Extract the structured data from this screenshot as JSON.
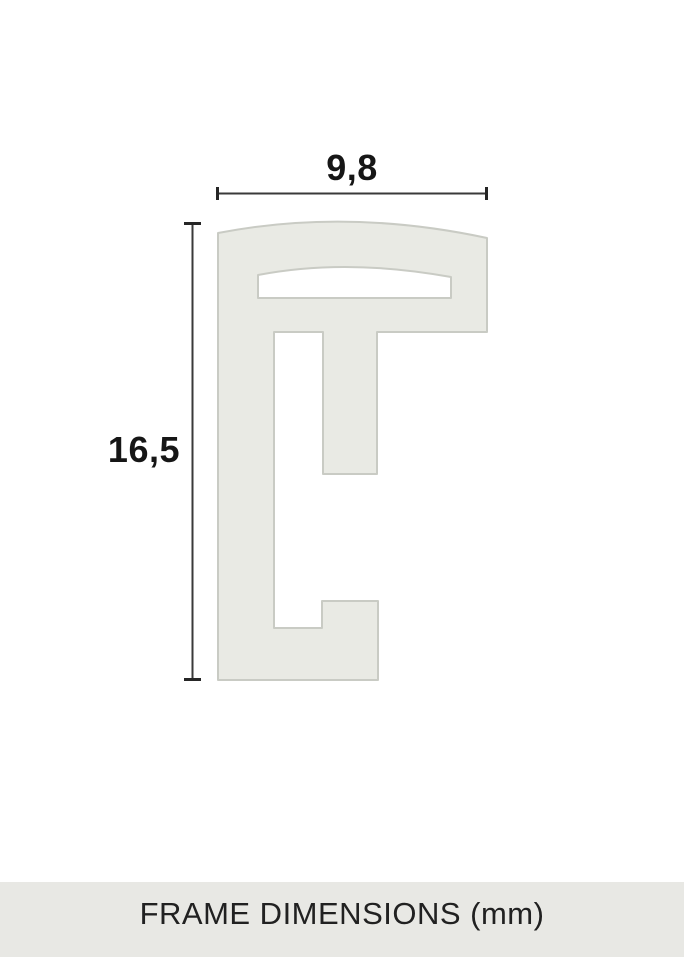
{
  "diagram": {
    "width_dimension_label": "9,8",
    "height_dimension_label": "16,5",
    "unit": "mm"
  },
  "footer": {
    "label": "FRAME DIMENSIONS (mm)"
  },
  "colors": {
    "page_background": "#ffffff",
    "profile_fill": "#e9eae4",
    "profile_outline": "#c9cbc4",
    "dimension_line": "#3a3a3a",
    "dimension_tick": "#262626",
    "label_text": "#161616",
    "footer_background": "#e8e8e4",
    "footer_text": "#212121"
  }
}
